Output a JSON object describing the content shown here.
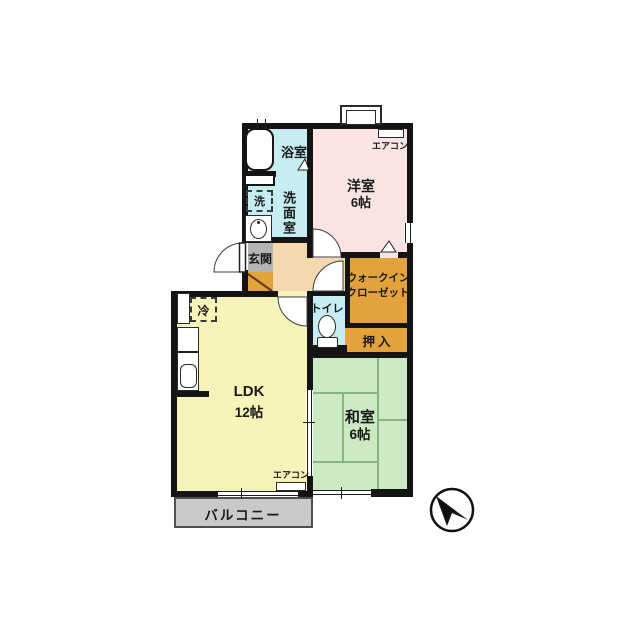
{
  "title": "apartment-floor-plan",
  "labels": {
    "bath": "浴室",
    "washroom": "洗面室",
    "washer": "洗",
    "entry": "玄関",
    "western": "洋室",
    "western_size": "6帖",
    "aircon": "エアコン",
    "wic_line1": "ウォークイン",
    "wic_line2": "クローゼット",
    "toilet": "トイレ",
    "oshiire": "押入",
    "fridge": "冷",
    "ldk": "LDK",
    "ldk_size": "12帖",
    "washitsu": "和室",
    "washitsu_size": "6帖",
    "balcony": "バルコニー"
  },
  "icons": {
    "compass": "north-arrow",
    "bathtub": "bathtub",
    "sink": "wash-basin",
    "toilet_bowl": "toilet-bowl"
  },
  "colors": {
    "wall": "#141414",
    "water": "#c6edf1",
    "western_room": "#f9e4e3",
    "hall": "#f5d8ae",
    "entry_tile": "#b4b4b4",
    "storage": "#e4a23c",
    "ldk": "#f8f3b9",
    "tatami": "#cde9c3",
    "tatami_line": "#85b57d",
    "balcony": "#c9c9c9"
  }
}
